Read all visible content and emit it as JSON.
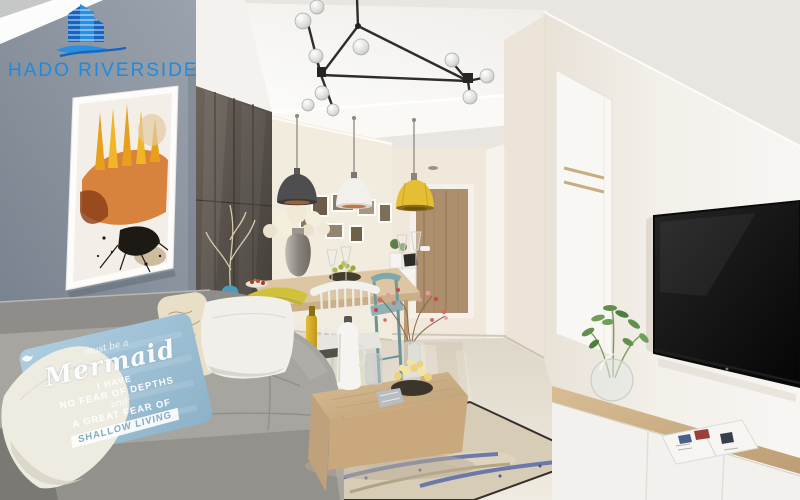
{
  "logo": {
    "text": "HADO RIVERSIDE",
    "color": "#1f8ade",
    "icon": "hado-buildings-wave-icon"
  },
  "pillow_quote": {
    "line1": "must be a",
    "line2": "Mermaid",
    "line3": "I HAVE",
    "line4": "NO FEAR OF DEPTHS",
    "line5": "and",
    "line6": "A GREAT FEAR OF",
    "line7": "SHALLOW LIVING"
  },
  "palette": {
    "wall_gray_blue": "#87919d",
    "ceiling_white": "#f7f5f1",
    "sofa_gray": "#a3a19c",
    "pillow_blue": "#9fc3d8",
    "pendant_dark": "#4e4d4f",
    "pendant_white": "#f2f0ec",
    "pendant_yellow": "#e5bf33",
    "cabinet_brown": "#57504a",
    "wood_light": "#cbae84",
    "floor_cream": "#e7e1d4",
    "art_orange": "#d2701e",
    "tv_black": "#0d0d0d",
    "rug_blue": "#3d56a4"
  }
}
